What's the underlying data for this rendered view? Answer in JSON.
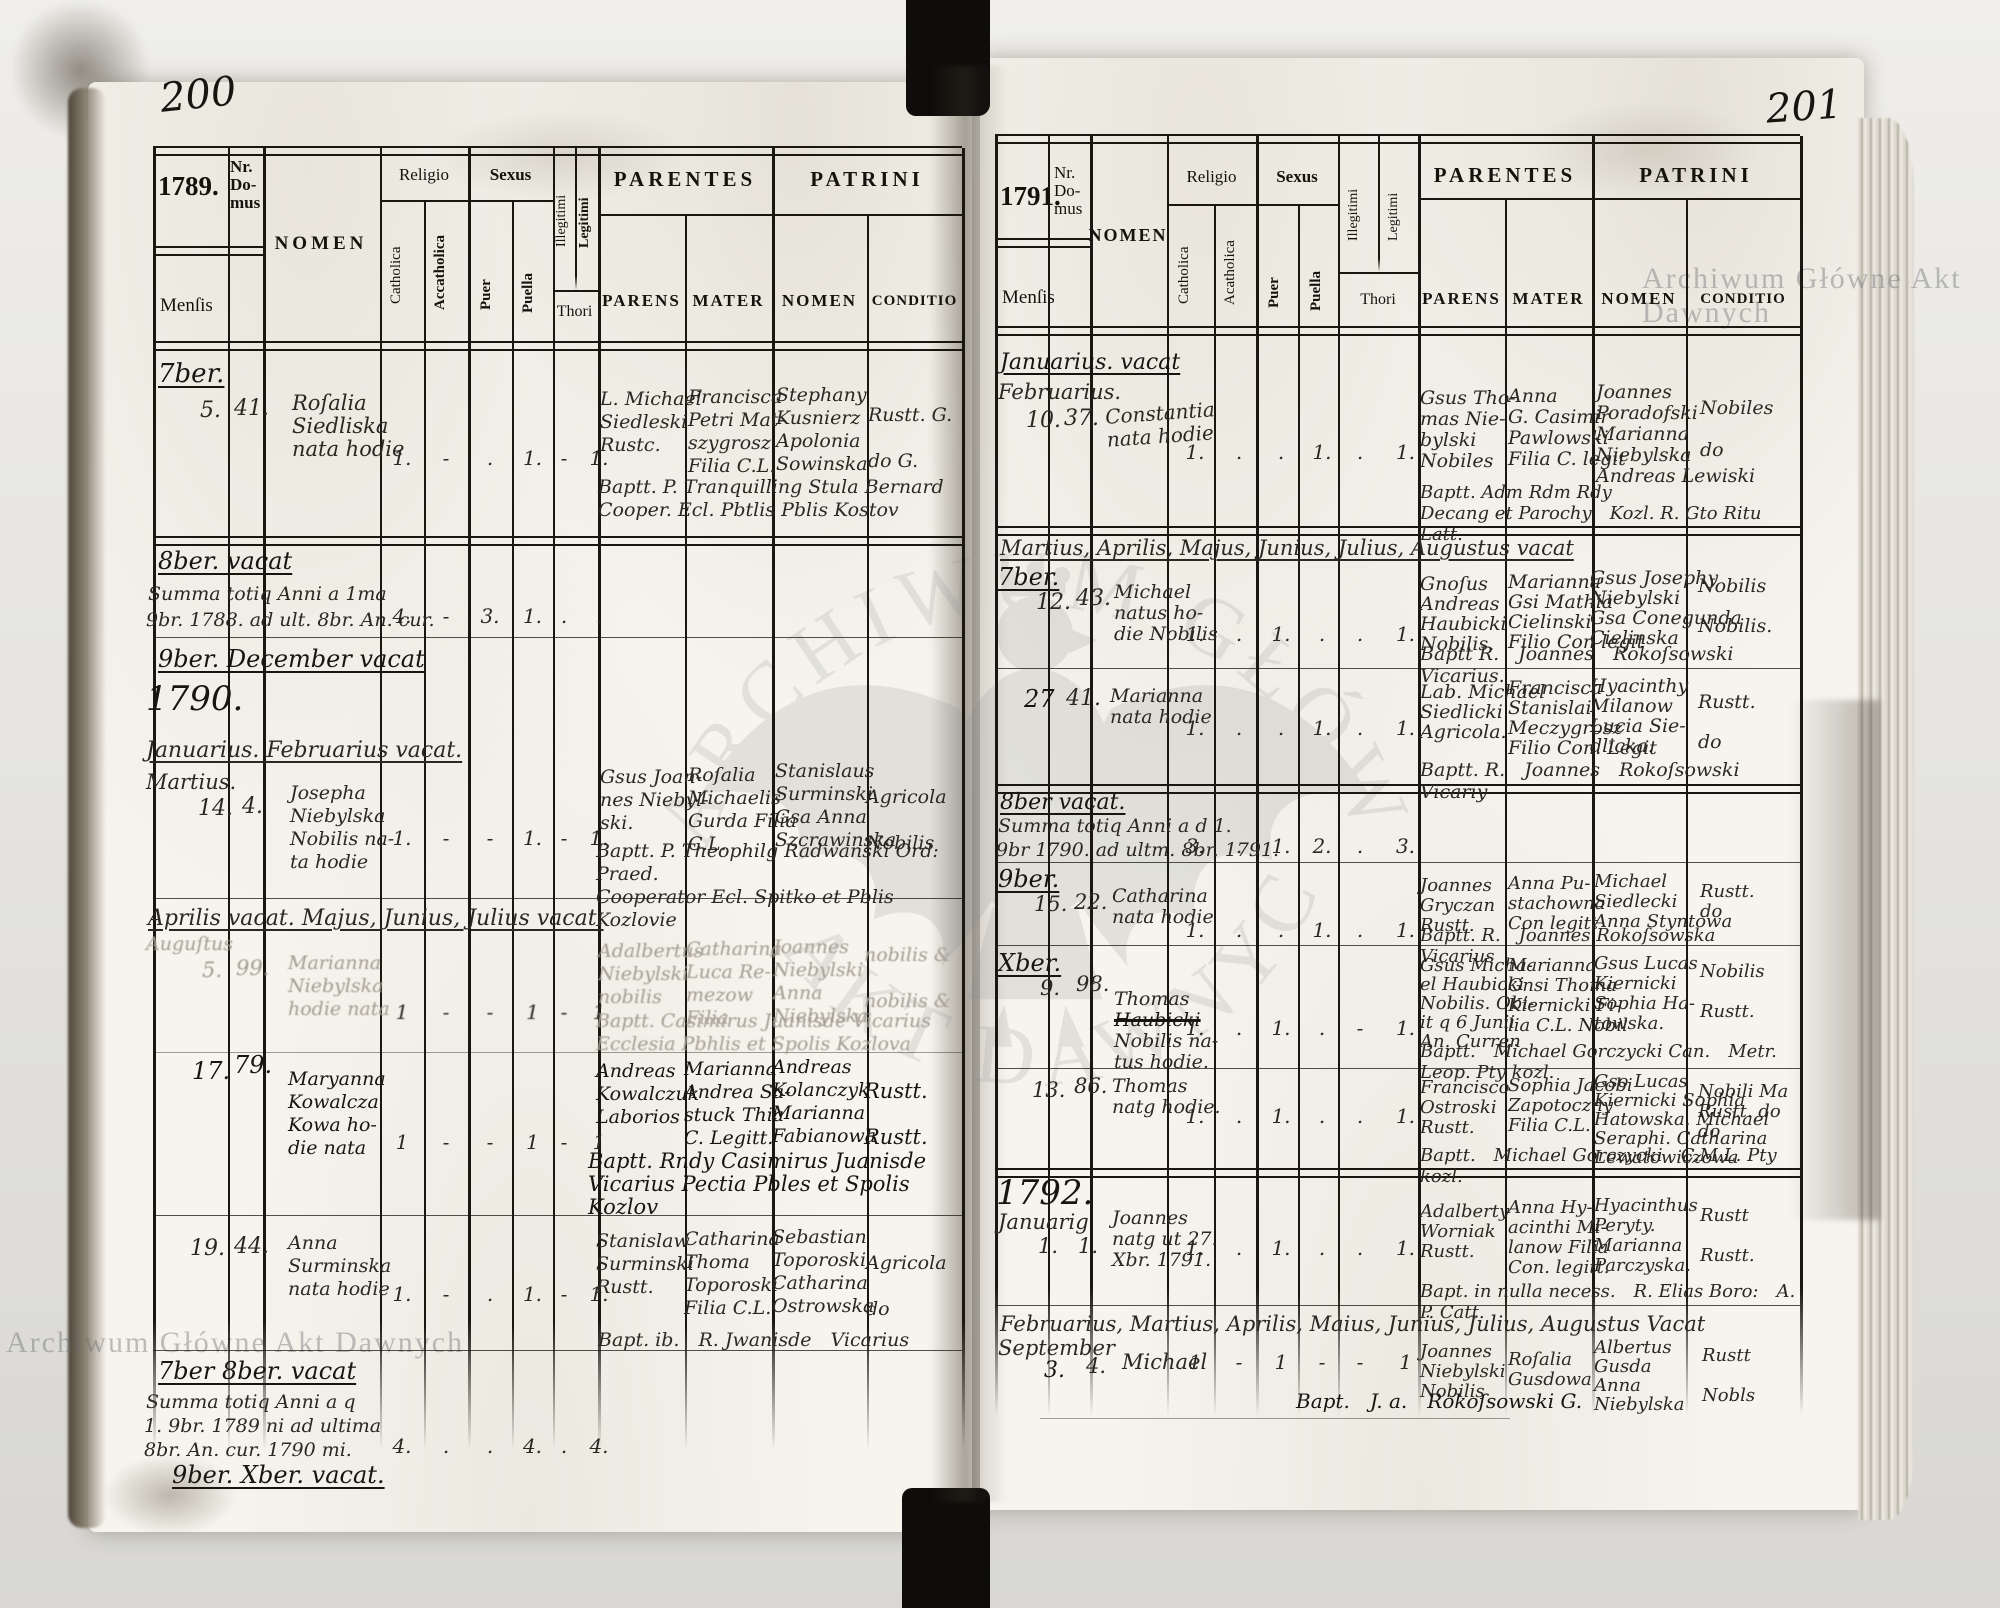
{
  "labels": {
    "mensis": "Menſis",
    "nr_domus": "Nr.\nDo-\nmus",
    "nomen": "NOMEN",
    "religio": "Religio",
    "catholica": "Catholica",
    "acatholica_left": "Accatholica",
    "acatholica_right": "Acatholica",
    "sexus": "Sexus",
    "puer": "Puer",
    "puella": "Puella",
    "illegitimi": "Illegitimi",
    "legitimi": "Legitimi",
    "thori": "Thori",
    "parentes": "PARENTES",
    "patrini": "PATRINI",
    "parens": "PARENS",
    "mater": "MATER",
    "patrini_nomen": "NOMEN",
    "conditio": "CONDITIO"
  },
  "watermark": {
    "text": "Archiwum Główne Akt Dawnych",
    "arc_top": "ARCHIWUM GŁÓWNE",
    "arc_bottom": "AKT DAWNYCH"
  },
  "left": {
    "page_number": "200",
    "year": "1789.",
    "sections": {
      "sept": "7ber.",
      "oct_vacat": "8ber. vacat",
      "sum1_l1": "Summa totiq Anni a 1ma",
      "sum1_l2": "9br. 1788. ad ult. 8br. An. cur.",
      "nov_dec_vacat": "9ber.  December  vacat",
      "year_1790": "1790.",
      "jan_feb_vacat": "Januarius.  Februarius  vacat.",
      "apr_jul_vacat": "Aprilis vacat.  Majus,  Junius,  Julius  vacat.",
      "sep_oct_vacat": "7ber  8ber.  vacat",
      "sum2_l1": "Summa totiq Anni a q",
      "sum2_l2": "1. 9br. 1789 ni  ad ultima",
      "sum2_l3": "8br. An. cur. 1790 mi.",
      "nov_dec2_vacat": "9ber.  Xber.  vacat."
    },
    "sum1_marks": {
      "c": "4.",
      "a": "-",
      "p": "3.",
      "g": "1.",
      "i": ".",
      "l": "."
    },
    "sum2_marks": {
      "c": "4.",
      "a": ".",
      "p": ".",
      "g": "4.",
      "i": ".",
      "l": "4."
    },
    "records": [
      {
        "day": "5.",
        "nr": "41.",
        "nomen": "Roſalia\nSiedliska\nnata hodie",
        "marks": {
          "c": "1.",
          "a": "-",
          "p": ".",
          "g": "1.",
          "i": "-",
          "l": "1."
        },
        "parens": "L. Michael\nSiedleski\nRustc.",
        "mater": "Francisca\nPetri Mat-\nszygrosz\nFilia C.L.",
        "patrini": "Stephany\nKusnierz\nApolonia\nSowinska",
        "conditio": "Rustt. G.\n\ndo  G.",
        "bapt": "Baptt. P. Tranquilling Stula Bernard\nCooper. Ecl. Pbtlis Pblis Kostov"
      },
      {
        "mensis": "Martius.",
        "day": "14.",
        "nr": "4.",
        "nomen": "Josepha\nNiebylska\nNobilis na-\nta hodie",
        "marks": {
          "c": "1.",
          "a": "-",
          "p": "-",
          "g": "1.",
          "i": "-",
          "l": "1."
        },
        "parens": "Gsus Joan-\nnes Niebyl-\nski.",
        "mater": "Roſalia\nMichaelis\nGurda Filia\nC.L.",
        "patrini": "Stanislaus\nSurminski\nGsa Anna\nSzcrawinska",
        "conditio": "Agricola\n\nNobilis",
        "bapt": "Baptt. P. Theophilg Radwanski Ord: Praed.\nCooperator Ecl. Spitko et Pblis Kozlovie"
      },
      {
        "mensis": "Auguſtus",
        "day": "5.",
        "nr": "99.",
        "nomen": "Marianna\nNiebylska\nhodie nata",
        "marks": {
          "c": "1",
          "a": "-",
          "p": "-",
          "g": "1",
          "i": "-",
          "l": "1"
        },
        "parens": "Adalbertus\nNiebylski\nnobilis",
        "mater": "Catharina\nLuca Re-\nmezow\nFilia",
        "patrini": "Joannes\nNiebylski\nAnna\nNiebylska",
        "conditio": "nobilis &\n\nnobilis &",
        "bapt": "Baptt. Casimirus Juanisde Vicarius\nEcclesia Pbhlis et Spolis Kozlova"
      },
      {
        "day": "17.",
        "nr": "79.",
        "nomen": "Maryanna\nKowalcza\nKowa ho-\ndie nata",
        "marks": {
          "c": "1",
          "a": "-",
          "p": "-",
          "g": "1",
          "i": "-",
          "l": "1"
        },
        "parens": "Andreas\nKowalczuk\nLaborios",
        "mater": "Marianna\nAndrea Sa-\nstuck Thia\nC. Legitt.",
        "patrini": "Andreas\nKolanczyk\nMarianna\nFabianowa",
        "conditio": "Rustt.\n\nRustt.",
        "bapt": "Baptt. Rndy Casimirus Juanisde\nVicarius Pectia Pbles et Spolis Kozlov"
      },
      {
        "day": "19.",
        "nr": "44.",
        "nomen": "Anna\nSurminska\nnata hodie",
        "marks": {
          "c": "1.",
          "a": "-",
          "p": ".",
          "g": "1.",
          "i": "-",
          "l": "1."
        },
        "parens": "Stanislaw\nSurminski\nRustt.",
        "mater": "Catharina\nThoma\nToporoski\nFilia C.L.",
        "patrini": "Sebastian\nToporoski\nCatharina\nOstrowska",
        "conditio": "Agricola\n\ndo",
        "bapt": "Bapt. ib. R. Jwanisde Vicarius"
      }
    ]
  },
  "right": {
    "page_number": "201",
    "year": "1791.",
    "sections": {
      "jan_vacat": "Januarius.  vacat",
      "mar_aug_vacat": "Martius,  Aprilis,  Majus,  Junius,  Julius,  Augustus  vacat",
      "oct_vacat": "8ber  vacat.",
      "sum_l1": "Summa totiq Anni a d 1.",
      "sum_l2": "9br 1790. ad ultm. 8br. 1791.",
      "year_1792": "1792.",
      "feb_aug_vacat": "Februarius,  Martius,  Aprilis,  Maius,  Junius,  Julius,  Augustus  Vacat"
    },
    "sum_marks": {
      "c": "3.",
      "a": ".",
      "p": "1.",
      "g": "2.",
      "i": ".",
      "l": "3."
    },
    "records": [
      {
        "mensis": "Februarius.",
        "day": "10.",
        "nr": "37.",
        "nomen": "Constantia\nnata hodie",
        "marks": {
          "c": "1.",
          "a": ".",
          "p": ".",
          "g": "1.",
          "i": ".",
          "l": "1."
        },
        "parens": "Gsus Tho-\nmas Nie-\nbylski\nNobiles",
        "mater": "Anna\nG. Casimir\nPawlowski\nFilia C. legit",
        "patrini": "Joannes\nPoradofski\nMarianna\nNiebylska\nAndreas Lewiski",
        "conditio": "Nobiles\n\ndo",
        "bapt": "Baptt. Adm Rdm Rdy\nDecang et Parochy Kozl. R. Gto Ritu Latt."
      },
      {
        "mensis": "7ber.",
        "day": "12.",
        "nr": "43.",
        "nomen": "Michael\nnatus ho-\ndie Nobilis",
        "marks": {
          "c": "1.",
          "a": ".",
          "p": "1.",
          "g": ".",
          "i": ".",
          "l": "1."
        },
        "parens": "Gnoſus\nAndreas\nHaubicki\nNobilis.",
        "mater": "Marianna\nGsi Mathia\nCielinski\nFilio Con legit",
        "patrini": "Gsus Josephy\nNiebylski\nGsa Conegunda\nCielinska",
        "conditio": "Nobilis\n\nNobilis.",
        "bapt": "Baptt R. Joannes Rokoſsowski Vicarius."
      },
      {
        "day": "27",
        "nr": "41.",
        "nomen": "Marianna\nnata hodie",
        "marks": {
          "c": "1.",
          "a": ".",
          "p": ".",
          "g": "1.",
          "i": ".",
          "l": "1."
        },
        "parens": "Lab. Michael\nSiedlicki\nAgricola.",
        "mater": "Francisca\nStanislai\nMeczygrosz\nFilio Con. Legit",
        "patrini": "Hyacinthy\nMilanow\nLucia Sie-\ndlicka.",
        "conditio": "Rustt.\n\ndo",
        "bapt": "Baptt. R. Joannes Rokoſsowski Vicariy"
      },
      {
        "mensis": "9ber.",
        "day": "15.",
        "nr": "22.",
        "nomen": "Catharina\nnata hodie",
        "marks": {
          "c": "1.",
          "a": ".",
          "p": ".",
          "g": "1.",
          "i": ".",
          "l": "1."
        },
        "parens": "Joannes\nGryczan\nRustt.",
        "mater": "Anna Pu-\nstachowna\nCon legitt",
        "patrini": "Michael\nSiedlecki\nAnna Styntowa",
        "conditio": "Rustt.\ndo",
        "bapt": "Baptt. R. Joannes Rokoſsowska Vicarius"
      },
      {
        "mensis": "Xber.",
        "day": "9.",
        "nr": "98.",
        "nomen_pre": "Thomas",
        "nomen_struck": "Haubicki",
        "nomen_post": "Nobilis na-\ntus hodie.",
        "marks": {
          "c": "1.",
          "a": ".",
          "p": "1.",
          "g": ".",
          "i": "-",
          "l": "1."
        },
        "parens": "Gsus Micha-\nel Haubicki\nNobilis. Obi-\nit q 6 Junii\nAn. Curren",
        "mater": "Marianna\nGnsi Thoma\nKiernicki Fi-\nlia C.L. Nobil",
        "patrini": "Gsus Lucas\nKiernicki\nSophia Ha-\ntowska.",
        "conditio": "Nobilis\n\nRustt.",
        "bapt": "Baptt. Michael Gorczycki Can. Metr. Leop. Pty kozl."
      },
      {
        "day": "13.",
        "nr": "86.",
        "nomen": "Thomas\nnatg hodie.",
        "marks": {
          "c": "1.",
          "a": ".",
          "p": "1.",
          "g": ".",
          "i": ".",
          "l": "1."
        },
        "parens": "Francisco\nOstroski\nRustt.",
        "mater": "Sophia Jacobi\nZapotoczny\nFilia C.L.",
        "patrini": "Gso Lucas\nKiernicki Sophia\nHatowska. Michael\nSeraphi. Catharina\nLewatowiczowa",
        "conditio": "Nobili Ma\nRustt. do\ndo",
        "bapt": "Baptt. Michael Gorczycki C.M.L. Pty kozl."
      },
      {
        "mensis": "Januarig",
        "day": "1.",
        "nr": "1.",
        "nomen": "Joannes\nnatg ut 27.\nXbr. 1791.",
        "marks": {
          "c": "1.",
          "a": ".",
          "p": "1.",
          "g": ".",
          "i": ".",
          "l": "1."
        },
        "parens": "Adalberty\nWorniak\nRustt.",
        "mater": "Anna Hy-\nacinthi Mi-\nlanow Filia\nCon. legitt.",
        "patrini": "Hyacinthus\nPeryty.\nMarianna\nParczyska.",
        "conditio": "Rustt\n\nRustt.",
        "bapt": "Bapt. in nulla necess. R. Elias Boro: A. P. Catt."
      },
      {
        "mensis": "September",
        "day": "3.",
        "nr": "4.",
        "nomen": "Michael",
        "marks": {
          "c": "1",
          "a": "-",
          "p": "1",
          "g": "-",
          "i": "-",
          "l": "1"
        },
        "parens": "Joannes\nNiebylski\nNobilis",
        "mater": "Roſalia\nGusdowa",
        "patrini": "Albertus\nGusda\nAnna\nNiebylska",
        "conditio": "Rustt\n\nNobls",
        "bapt": "Bapt. J. a. Rokoſsowski G."
      }
    ]
  }
}
